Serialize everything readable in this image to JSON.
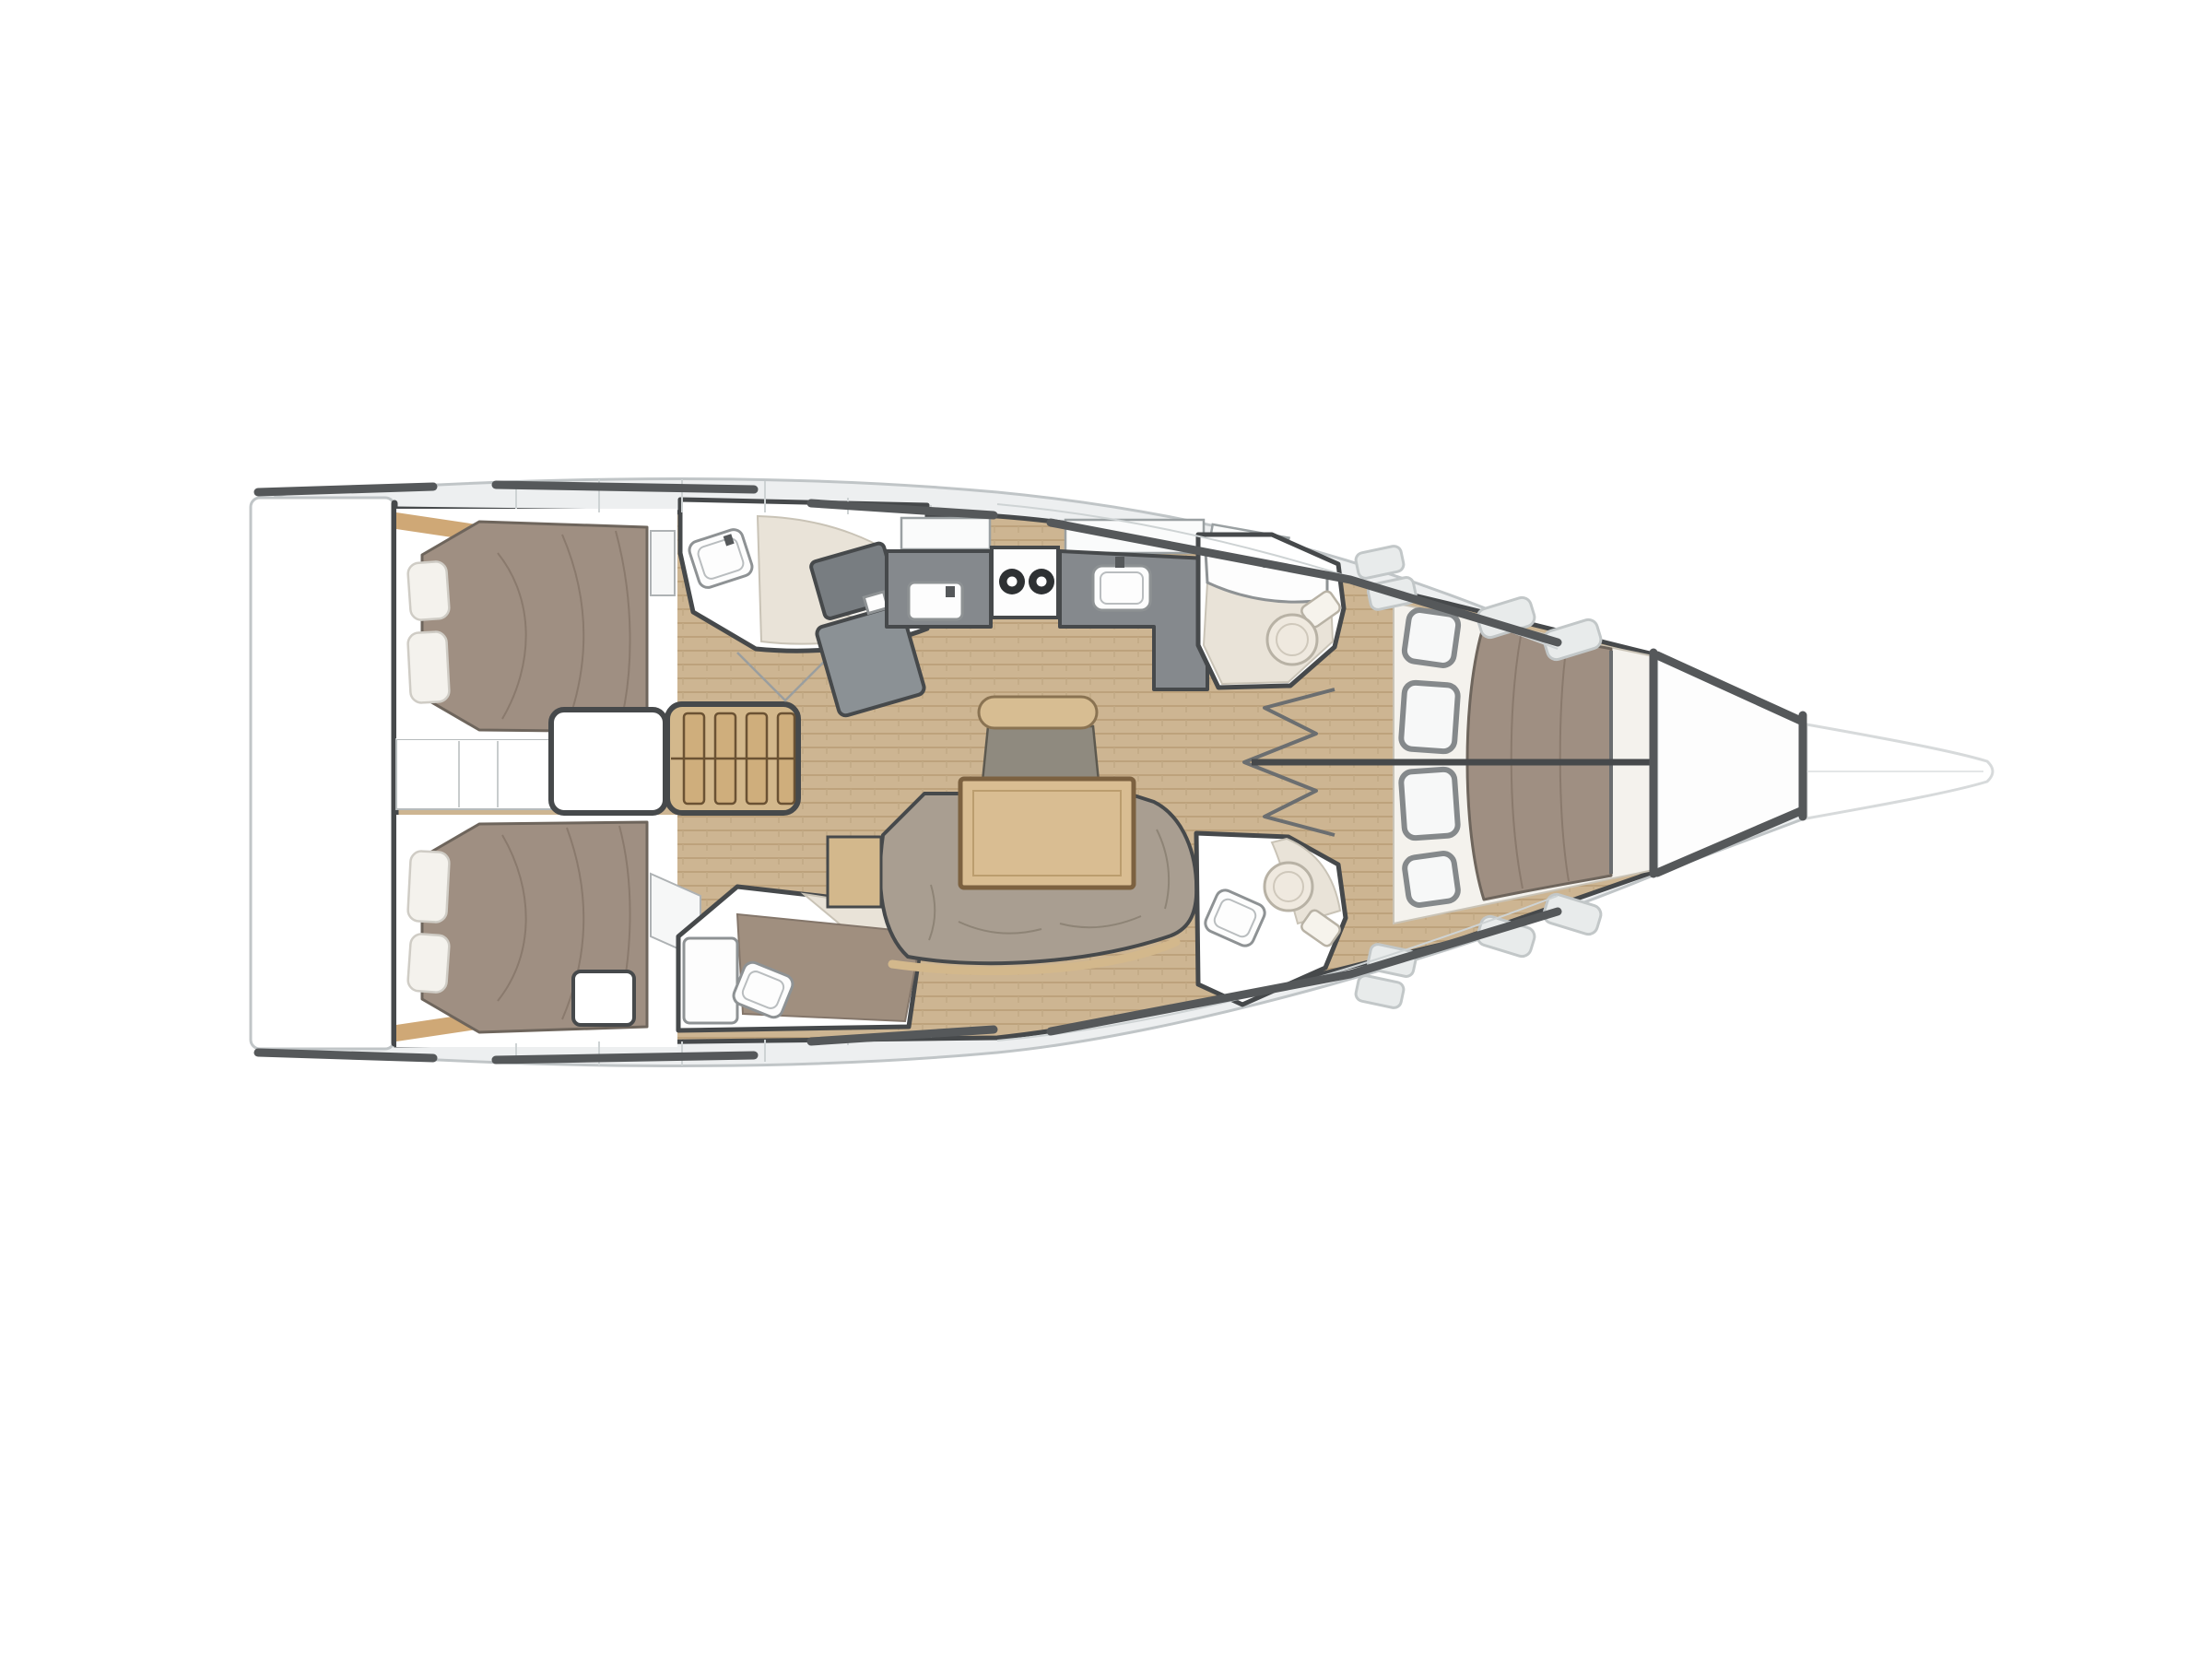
{
  "diagram": {
    "kind": "yacht-interior-deck-plan",
    "orientation": "bow-right",
    "areas": [
      {
        "id": "swim-platform",
        "label": "swim platform"
      },
      {
        "id": "aft-cabin-starboard",
        "label": "aft double cabin (top)"
      },
      {
        "id": "aft-cabin-port",
        "label": "aft double cabin (bottom)"
      },
      {
        "id": "companionway-steps",
        "label": "companionway steps"
      },
      {
        "id": "engine-compartment",
        "label": "engine compartment"
      },
      {
        "id": "aft-head-starboard",
        "label": "aft head with shower (top)"
      },
      {
        "id": "aft-head-port",
        "label": "aft head with shower (bottom)"
      },
      {
        "id": "nav-station",
        "label": "chart table"
      },
      {
        "id": "galley",
        "label": "galley with stove, sink and fridge"
      },
      {
        "id": "salon",
        "label": "salon with table, sofa and seat"
      },
      {
        "id": "head-starboard",
        "label": "midship head (top)"
      },
      {
        "id": "head-port",
        "label": "midship head (bottom)"
      },
      {
        "id": "forward-cabin",
        "label": "forward V-berth cabin"
      },
      {
        "id": "anchor-locker",
        "label": "anchor locker"
      },
      {
        "id": "bowsprit",
        "label": "bowsprit"
      }
    ]
  },
  "palette": {
    "background": "#ffffff",
    "deck": "#edeff0",
    "deck-line": "#ced3d4",
    "hull-stroke": "#c0c5c7",
    "bowsprit-stroke": "#d7dadb",
    "toe-rail": "#55585a",
    "wall-dark": "#46494b",
    "wood": "#cdb592",
    "wood-line": "#bda27c",
    "wood-trim": "#cfa876",
    "ladder-wood": "#d3b88c",
    "mattress": "#9f8f82",
    "mattress-stroke": "#6e655c",
    "mattress-line": "#8a7a6d",
    "bedding": "#f4f2ed",
    "bedding-stroke": "#cfccc5",
    "sofa": "#a99e91",
    "sofa-line": "#8e8476",
    "table-wood": "#d9bd92",
    "table-border": "#7c6140",
    "counter": "#85898d",
    "fixture-stroke": "#8e9294",
    "ceramic": "#e9e3d8",
    "ceramic-stroke": "#c9c3b6",
    "locker-stroke": "#85898b",
    "window-fill": "#e8ebeb",
    "window-stroke": "#c2c7c8"
  }
}
